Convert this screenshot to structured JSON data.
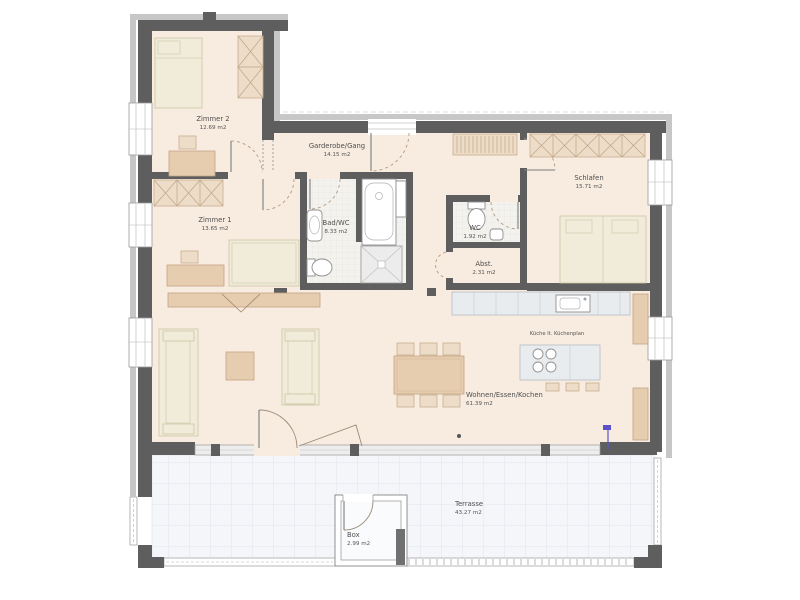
{
  "rooms": {
    "zimmer2": {
      "name": "Zimmer 2",
      "area": "12.69 m2"
    },
    "zimmer1": {
      "name": "Zimmer 1",
      "area": "13.65 m2"
    },
    "garderobe_gang": {
      "name": "Garderobe/Gang",
      "area": "14.15 m2"
    },
    "bad_wc": {
      "name": "Bad/WC",
      "area": "8.33 m2"
    },
    "wc": {
      "name": "WC",
      "area": "1.92 m2"
    },
    "abstellraum": {
      "name": "Abst.",
      "area": "2.31 m2"
    },
    "schlafen": {
      "name": "Schlafen",
      "area": "15.71 m2"
    },
    "wohnen_essen_kochen": {
      "name": "Wohnen/Essen/Kochen",
      "area": "61.39 m2"
    },
    "terrasse": {
      "name": "Terrasse",
      "area": "43.27 m2"
    },
    "box": {
      "name": "Box",
      "area": "2.99 m2"
    }
  },
  "annotations": {
    "kitchen_note": "Küche lt. Küchenplan",
    "shower_size": "Du 110/100"
  },
  "colors": {
    "wall": "#5e5e5e",
    "wall_outer": "#c7c7c7",
    "floor_beige": "#f8ebdf",
    "bath_tile": "#f3f2ee",
    "terrace": "#f4f6f9",
    "furniture_tan": "#e7cdb0",
    "furniture_pale": "#f0ecd9",
    "kitchen_gray": "#e9ecef",
    "accent_blue": "#5b51c8"
  }
}
